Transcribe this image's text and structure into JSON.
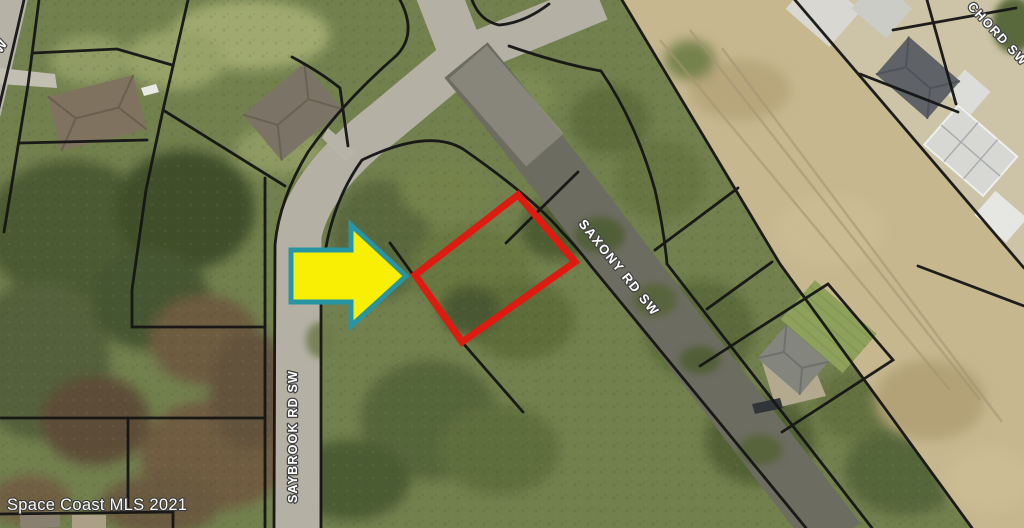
{
  "map": {
    "type": "aerial-parcel-map",
    "street_labels": {
      "saxony": "SAXONY RD SW",
      "saybrook": "SAYBROOK RD SW",
      "chord": "CHORD SW",
      "corner_fragment": "W"
    },
    "watermark": "Space Coast MLS 2021",
    "highlight": {
      "parcel_outline_color": "#dd1b10",
      "arrow_fill": "#f8ef04",
      "arrow_border": "#2795a3"
    },
    "colors": {
      "parcel_line": "#151515",
      "label_fill": "#ffffff",
      "label_outline": "#434343",
      "watermark_fill": "#fdfdfd",
      "watermark_outline": "#3a3a3a"
    }
  }
}
